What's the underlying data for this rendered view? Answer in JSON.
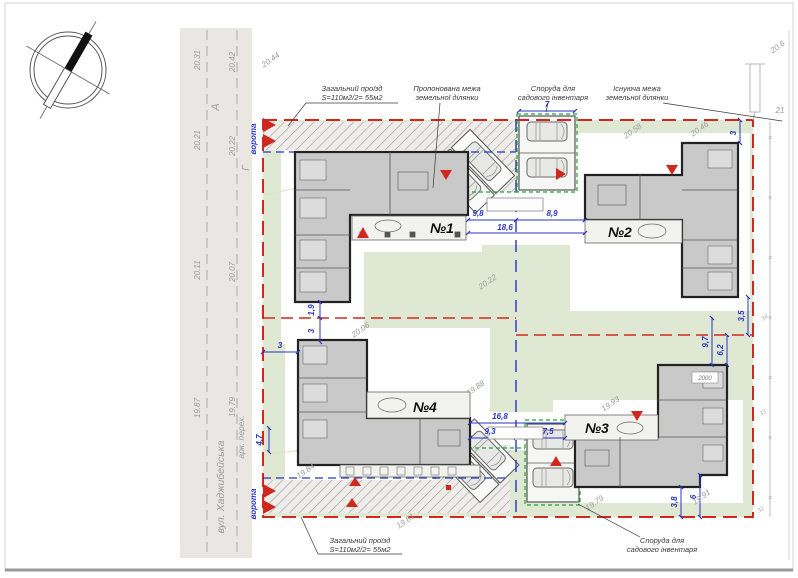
{
  "title": "Схема посадки будівель",
  "stamps": {
    "left": "юк",
    "right": "2юк"
  },
  "notes": [
    {
      "num": "№1",
      "area": "Sділянки – 0,0640+0,0055=0,0695га",
      "house": "Sбудинка – 140м²"
    },
    {
      "num": "№2",
      "area": "Sділянки – 0,0740+0,0055=0,0795га",
      "house": "Sбудинка – 135м²"
    },
    {
      "num": "№3",
      "area": "Sділянки – 0,0740+0,0055=0,0795га",
      "house": "Sбудинка – 150м²"
    },
    {
      "num": "№4",
      "area": "Sділянки – 0,0640+0,0055=0,0695га",
      "house": "Sбудинка – 150м²"
    }
  ],
  "legend": {
    "driveway_line1": "Загальний проїзд",
    "driveway_line2": "S=110м2/2= 55м2",
    "proposed_line1": "Пропонована межа",
    "proposed_line2": "земельної ділянки",
    "shed_line1": "Споруда для",
    "shed_line2": "садового інвентаря",
    "existing_line1": "Існуюча межа",
    "existing_line2": "земельної ділянки"
  },
  "road": {
    "street": "вул. Хаджибейська",
    "crossing": "арк. перех.",
    "letter_a": "А",
    "letter_g": "Г",
    "gate": "ворота",
    "width": "4,7"
  },
  "buildings": {
    "b1": "№1",
    "b2": "№2",
    "b3": "№3",
    "b4": "№4"
  },
  "dims": {
    "d98": "9,8",
    "d89": "8,9",
    "d186": "18,6",
    "d168": "16,8",
    "d93": "9,3",
    "d75": "7,5",
    "d7": "7",
    "d3a": "3",
    "d35": "3,5",
    "d97": "9,7",
    "d62": "6,2",
    "d3b": "3",
    "d19": "1,9",
    "d3c": "3",
    "d38": "3,8",
    "d6": "6"
  },
  "levels": {
    "l2031": "20.31",
    "l2042": "20.42",
    "l2021": "20.21",
    "l2022": "20.22",
    "l2011": "20.11",
    "l2007": "20.07",
    "l1987": "19.87",
    "l1979": "19.79",
    "l2044": "20.44",
    "l2058": "20.58",
    "l2046": "20.46",
    "l206": "20.6",
    "l21": "21",
    "l2006": "20.06",
    "l2022c": "20.22",
    "l1988": "19.88",
    "l1993": "19.93",
    "l1984": "19.84",
    "l1981": "19.81",
    "l1979b": "19.79",
    "l1991": "19.91",
    "f34": "34",
    "f33": "33",
    "f32": "32",
    "b2000": "2000"
  },
  "colors": {
    "existing_boundary": "#d0281e",
    "proposed_boundary": "#2a35c0",
    "shed_boundary": "#1fa33a",
    "lawn": "#dfe8d2",
    "road": "#e9e7e3",
    "building": "#c9c9c9"
  }
}
